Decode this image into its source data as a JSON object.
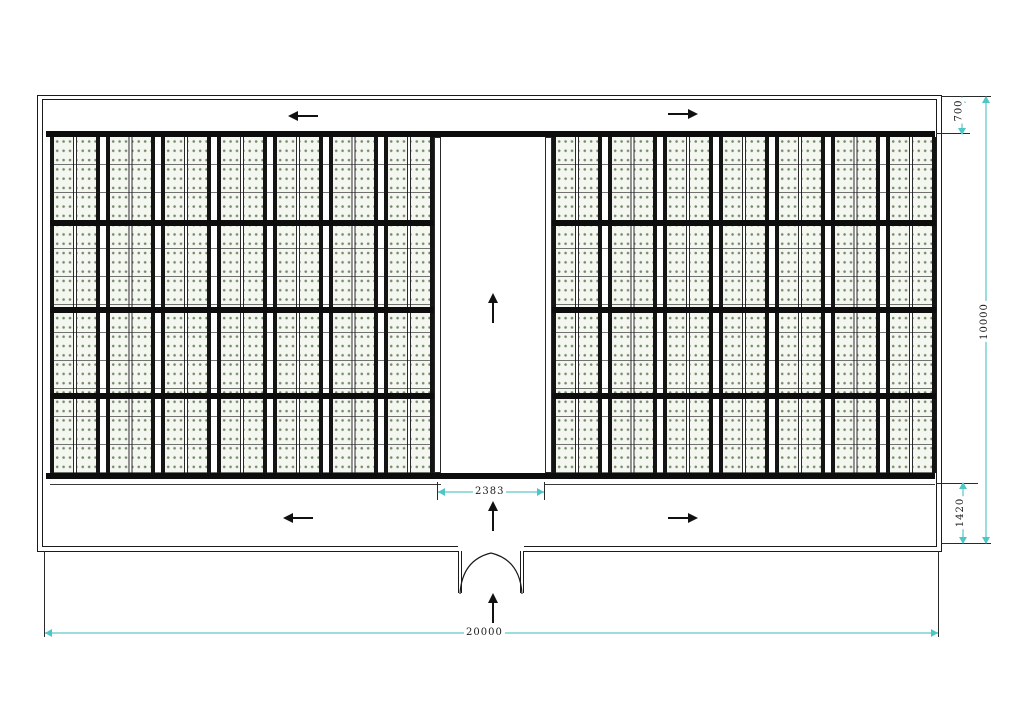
{
  "dimensions": {
    "top_offset": "700",
    "building_height": "10000",
    "bottom_offset": "1420",
    "aisle_width": "2383",
    "building_width": "20000"
  },
  "flow_arrows": {
    "top_left": "left",
    "top_right": "right",
    "center_aisle": "up",
    "bottom_left": "left",
    "bottom_center": "up",
    "bottom_right": "right",
    "entrance": "up"
  },
  "colors": {
    "dim_line": "#9bdcdc",
    "dim_tick": "#4fc6c6",
    "rack_dot": "#778a6d",
    "rack_bg": "#f4f7f0",
    "line": "#1a1a1a"
  }
}
